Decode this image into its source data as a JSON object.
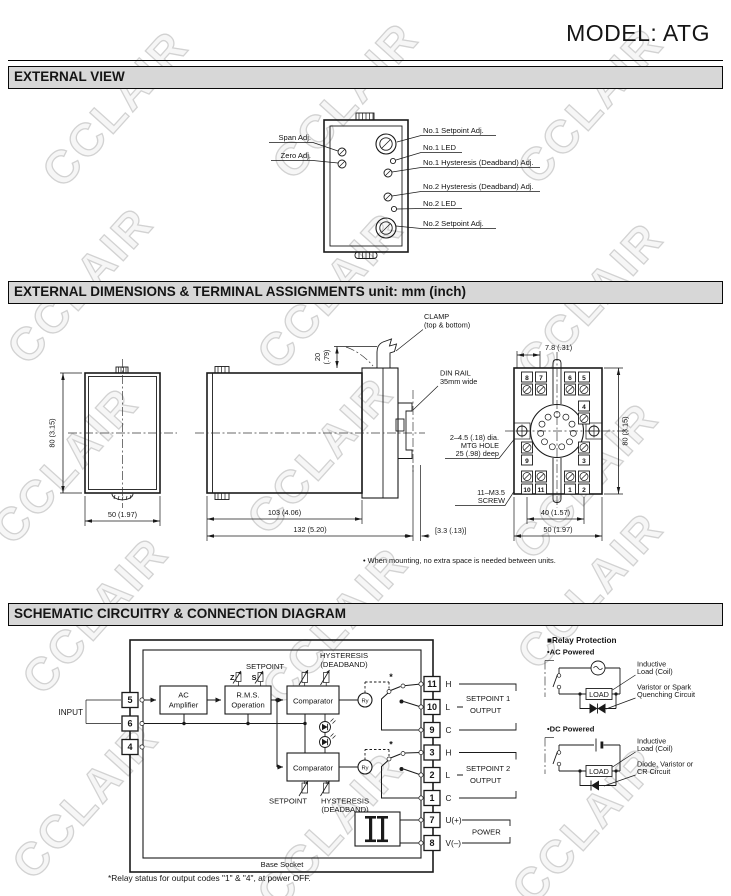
{
  "watermark": {
    "text": "CCLAIR"
  },
  "header": {
    "model_title": "MODEL: ATG"
  },
  "section_titles": {
    "external_view": "EXTERNAL VIEW",
    "dimensions": "EXTERNAL DIMENSIONS & TERMINAL ASSIGNMENTS unit: mm (inch)",
    "schematic": "SCHEMATIC CIRCUITRY & CONNECTION DIAGRAM"
  },
  "external_view": {
    "span_adj": "Span Adj.",
    "zero_adj": "Zero Adj.",
    "no1_setpoint": "No.1 Setpoint Adj.",
    "no1_led": "No.1 LED",
    "no1_hyst": "No.1 Hysteresis (Deadband) Adj.",
    "no2_hyst": "No.2 Hysteresis (Deadband) Adj.",
    "no2_led": "No.2 LED",
    "no2_setpoint": "No.2 Setpoint Adj."
  },
  "dimensions": {
    "front_height": "80 (3.15)",
    "front_width": "50 (1.97)",
    "clamp_dim_top": "20",
    "clamp_dim_bottom": "(.79)",
    "clamp_line1": "CLAMP",
    "clamp_line2": "(top & bottom)",
    "din_line1": "DIN RAIL",
    "din_line2": "35mm wide",
    "body_length": "103 (4.06)",
    "total_length": "132 (5.20)",
    "rail_offset": "[3.3 (.13)]",
    "mtg_line1": "2–4.5 (.18) dia.",
    "mtg_line2": "MTG HOLE",
    "mtg_line3": "25 (.98) deep",
    "screw_line1": "11–M3.5",
    "screw_line2": "SCREW",
    "socket_top_dim": "7.8 (.31)",
    "socket_height": "80 (3.15)",
    "socket_width_inner": "40 (1.57)",
    "socket_width_outer": "50 (1.97)",
    "note": "• When mounting, no extra space is needed between units.",
    "terminals": {
      "t8": "8",
      "t7": "7",
      "t6": "6",
      "t5": "5",
      "t4": "4",
      "t9": "9",
      "t3": "3",
      "t10": "10",
      "t11": "11",
      "t1": "1",
      "t2": "2"
    }
  },
  "schematic": {
    "input": "INPUT",
    "amp_line1": "AC",
    "amp_line2": "Amplifier",
    "rms_line1": "R.M.S.",
    "rms_line2": "Operation",
    "comparator": "Comparator",
    "relay": "Ry",
    "z": "Z",
    "s": "S",
    "setpoint": "SETPOINT",
    "hyst_line1": "HYSTERESIS",
    "hyst_line2": "(DEADBAND)",
    "star": "*",
    "t5": "5",
    "t6": "6",
    "t4": "4",
    "t11": "11",
    "t10": "10",
    "t9": "9",
    "t3": "3",
    "t2": "2",
    "t1": "1",
    "t7": "7",
    "t8": "8",
    "h": "H",
    "l": "L",
    "c": "C",
    "u": "U(+)",
    "v": "V(–)",
    "sp1_line1": "SETPOINT 1",
    "sp1_line2": "OUTPUT",
    "sp2_line1": "SETPOINT 2",
    "sp2_line2": "OUTPUT",
    "power": "POWER",
    "base_socket": "Base Socket",
    "footnote": "*Relay status for output codes \"1\" & \"4\", at power OFF."
  },
  "relay_protection": {
    "title": "■Relay Protection",
    "ac": "•AC Powered",
    "dc": "•DC Powered",
    "load": "LOAD",
    "inductive_line1": "Inductive",
    "inductive_line2": "Load (Coil)",
    "varistor_line1": "Varistor or Spark",
    "varistor_line2": "Quenching Circuit",
    "diode_line1": "Diode, Varistor or",
    "diode_line2": "CR Circuit"
  }
}
